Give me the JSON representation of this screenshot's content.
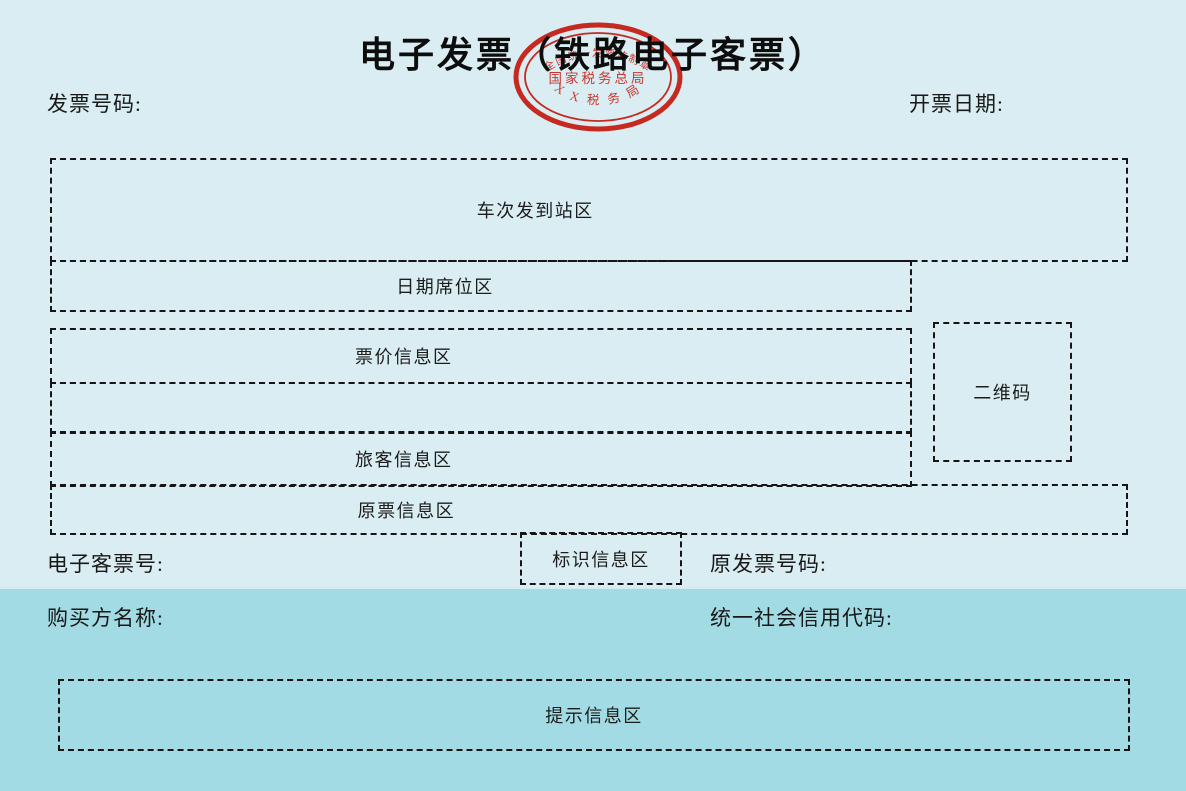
{
  "page": {
    "title": "电子发票（铁路电子客票）",
    "colors": {
      "background_top": "#d9edf2",
      "background_bottom": "#a2dbe4",
      "dash_border": "#161616",
      "seal_red": "#c5291f",
      "text": "#141414"
    }
  },
  "seal": {
    "arc_top_text": "全国统一发票监制章",
    "center_text": "国家税务总局",
    "arc_bottom_text": "X X 税 务 局"
  },
  "header": {
    "invoice_number_label": "发票号码:",
    "invoice_date_label": "开票日期:"
  },
  "zones": {
    "train_station_label": "车次发到站区",
    "date_seat_label": "日期席位区",
    "fare_info_label": "票价信息区",
    "passenger_info_label": "旅客信息区",
    "original_ticket_label": "原票信息区",
    "qr_code_label": "二维码",
    "identification_label": "标识信息区",
    "notice_label": "提示信息区"
  },
  "fields": {
    "eticket_number_label": "电子客票号:",
    "original_invoice_number_label": "原发票号码:",
    "buyer_name_label": "购买方名称:",
    "credit_code_label": "统一社会信用代码:"
  }
}
